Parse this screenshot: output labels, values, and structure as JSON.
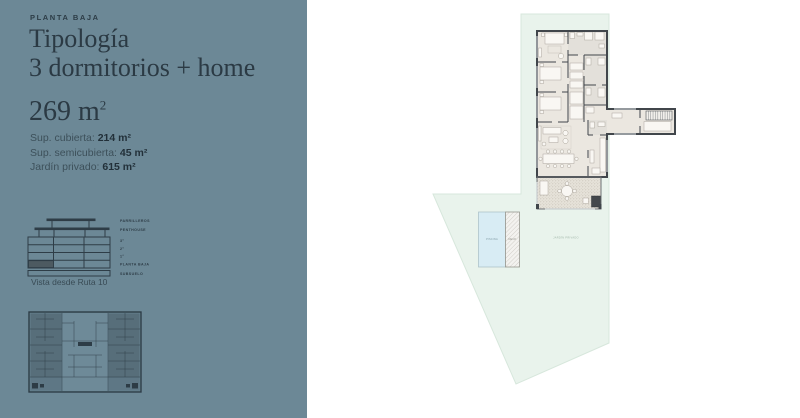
{
  "panel": {
    "eyebrow": "PLANTA BAJA",
    "title_line1": "Tipología",
    "title_line2": "3 dormitorios + home",
    "area_base": "269 m",
    "area_sup": "2",
    "specs": [
      {
        "label": "Sup. cubierta: ",
        "value": "214 m²"
      },
      {
        "label": "Sup. semicubierta: ",
        "value": "45 m²"
      },
      {
        "label": "Jardín privado: ",
        "value": "615 m²"
      }
    ],
    "elevation": {
      "levels": [
        "PARRILLEROS",
        "PENTHOUSE",
        "3°",
        "2°",
        "1°",
        "PLANTA BAJA",
        "SUBSUELO"
      ],
      "caption": "Vista desde Ruta 10"
    }
  },
  "site": {
    "pool_label": "PISCINA",
    "deck_label": "DECK",
    "garden_label": "JARDÍN PRIVADO"
  },
  "colors": {
    "panel_bg": "#6c8896",
    "text_dark": "#2b3a44",
    "garden_green": "#e9f3ec",
    "pool_blue": "#d8ecf4",
    "plan_floor": "#ebe7e0",
    "wall": "#41464b"
  }
}
